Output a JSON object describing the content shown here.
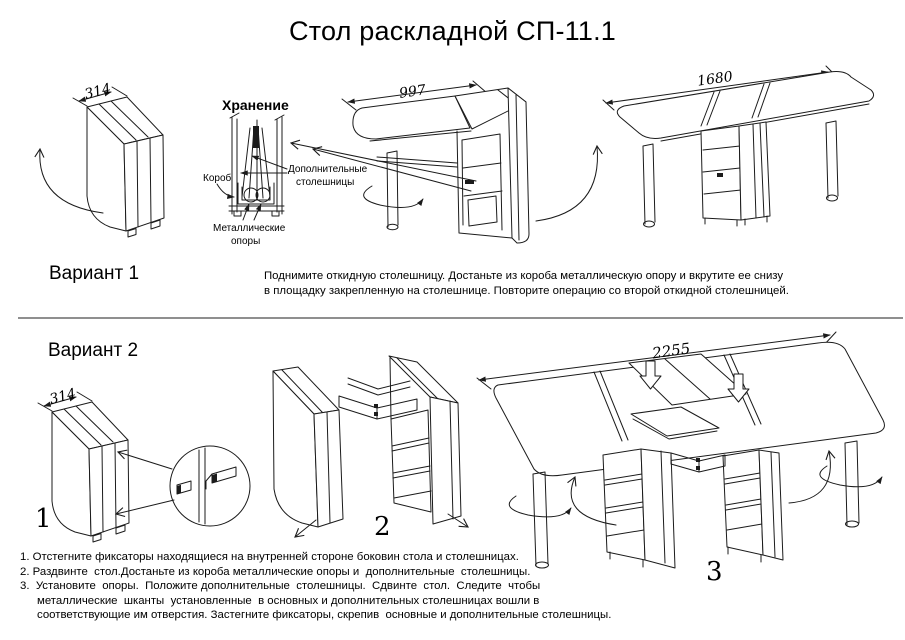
{
  "title": "Стол раскладной СП-11.1",
  "colors": {
    "ink": "#1b1b1b",
    "divider": "#8f8f8f",
    "background": "#ffffff"
  },
  "variant1": {
    "label": "Вариант 1",
    "folded_width": "314",
    "half_open_width": "997",
    "full_open_width": "1680",
    "storage": {
      "title": "Хранение",
      "box_label": "Короб",
      "extra_tops_line1": "Дополнительные",
      "extra_tops_line2": "столешницы",
      "supports_line1": "Металлические",
      "supports_line2": "опоры"
    },
    "instructions_line1": "Поднимите откидную столешницу. Достаньте из короба металлическую опору и вкрутите ее снизу",
    "instructions_line2": "в площадку закрепленную на столешнице. Повторите операцию со второй откидной столешницей."
  },
  "variant2": {
    "label": "Вариант 2",
    "folded_width": "314",
    "extended_width": "2255",
    "step_numbers": [
      "1",
      "2",
      "3"
    ],
    "instructions": [
      "1. Отстегните фиксаторы находящиеся на внутренней стороне боковин стола и столешницах.",
      "2. Раздвинте  стол.Достаньте из короба металлические опоры и  дополнительные  столешницы.",
      "3.  Установите  опоры.  Положите дополнительные  столешницы.  Сдвинте  стол.  Следите  чтобы",
      "металлические  шканты  установленные  в основных и дополнительных столешницах вошли в",
      "соответствующие им отверстия. Застегните фиксаторы, скрепив  основные и дополнительные столешницы."
    ]
  }
}
